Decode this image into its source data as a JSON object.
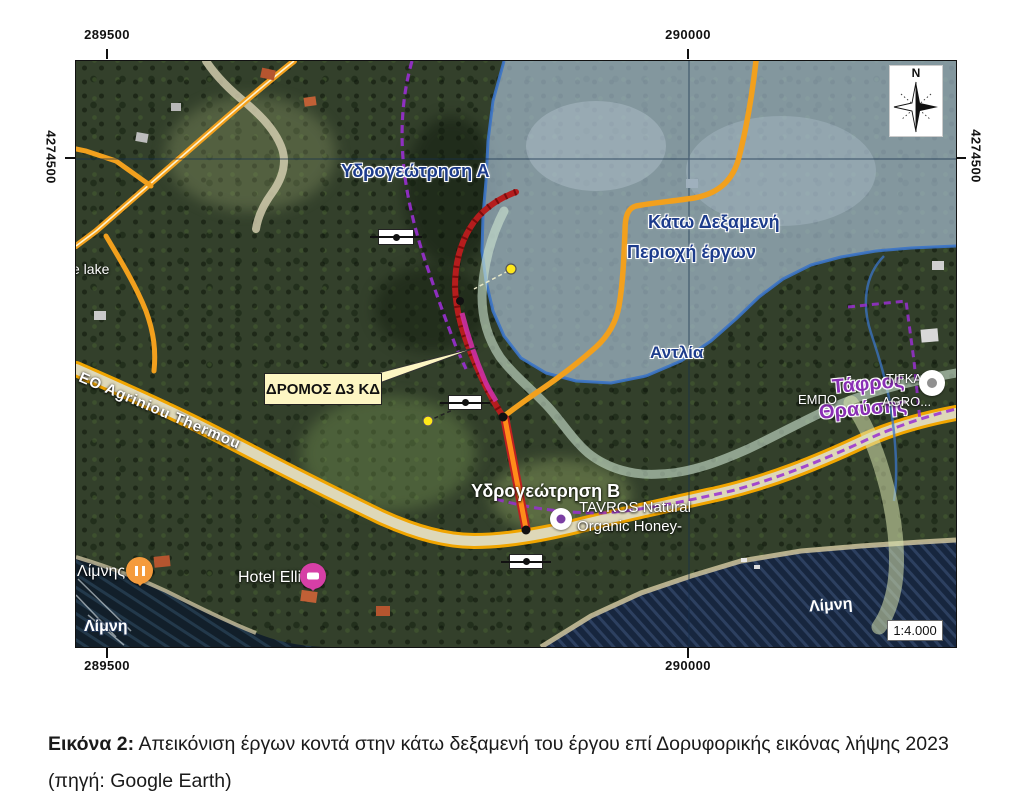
{
  "figure": {
    "caption": {
      "label": "Εικόνα 2:",
      "text": " Απεικόνιση έργων κοντά στην κάτω δεξαμενή του έργου επί Δορυφορικής εικόνας λήψης 2023 (πηγή: Google Earth)"
    }
  },
  "map": {
    "grid": {
      "top_left": "289500",
      "top_right": "290000",
      "bottom_left": "289500",
      "bottom_right": "290000",
      "left": "4274500",
      "right": "4274500"
    },
    "compass_north": "N",
    "scale_text": "1:4.000",
    "annotations": {
      "borehole_a": "Υδρογεώτρηση Α",
      "lower_reservoir": "Κάτω Δεξαμενή",
      "works_area": "Περιοχή έργων",
      "pump": "Αντλία",
      "borehole_b": "Υδρογεώτρηση Β",
      "fracture_trench_line1": "Τάφρος",
      "fracture_trench_line2": "Θραύσης",
      "road_callout": "ΔΡΟΜΟΣ Δ3 ΚΔ"
    },
    "base_labels": {
      "lake_partial": "e lake",
      "lake_sw": "Λίμνη",
      "lake_se": "Λίμνη",
      "limnis_poi": "Λίμνης",
      "hotel": "Hotel Elli",
      "tavros_line1": "TAVROS  Natural",
      "tavros_line2": "Organic Honey-",
      "tigkas_top": "ΤΙΓΚΑΣ",
      "tigkas_left": "ΕΜΠΟ",
      "tigkas_right": "AGRO...",
      "road_name": "EO Agriniou Thermou"
    },
    "colors": {
      "project_area_fill": "#aac1d6",
      "project_area_border": "#3b74c8",
      "road_orange": "#f2a01d",
      "rail_red": "#b51d1d",
      "pink_segment": "#cf2fa3",
      "channel_teal": "#cfe6d2",
      "boundary_purple": "#992fd0",
      "callout_bg": "#fdf6c3",
      "water_dark": "#17263e",
      "annotation_blue": "#1d3c8c",
      "trench_purple": "#8a2fb5"
    }
  }
}
